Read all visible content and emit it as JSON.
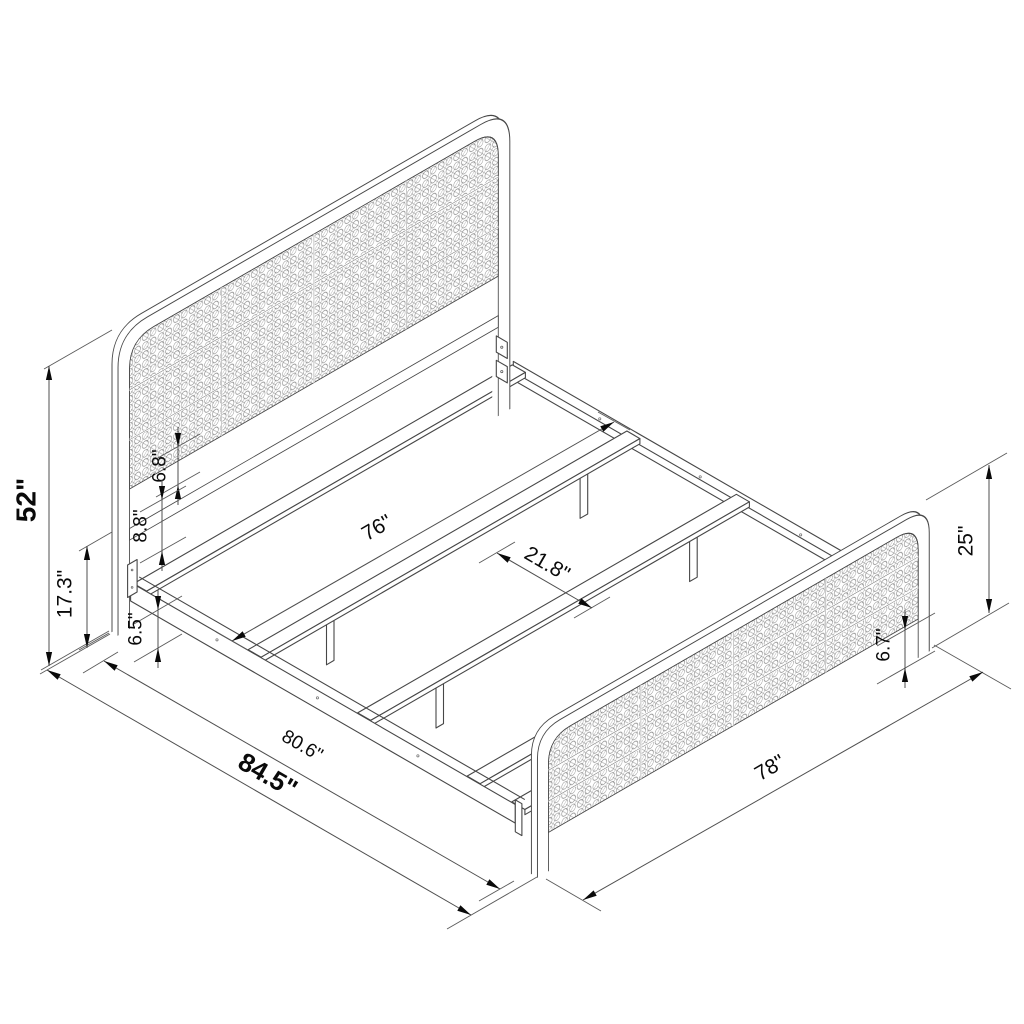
{
  "diagram": {
    "type": "isometric_dimension_drawing",
    "subject": "metal platform bed frame with cane headboard and footboard",
    "background_color": "#ffffff",
    "line_color": "#474747",
    "dimension_text_color": "#0a0a0a",
    "dimensions": [
      {
        "id": "headboard-height",
        "label": "52\"",
        "emphasis": "bold"
      },
      {
        "id": "floor-to-crossbar",
        "label": "17.3\"",
        "emphasis": "regular"
      },
      {
        "id": "crossbar-to-panel-gap",
        "label": "6.8\"",
        "emphasis": "regular"
      },
      {
        "id": "rail-to-panel-gap",
        "label": "8.8\"",
        "emphasis": "regular"
      },
      {
        "id": "floor-to-rail-clearance",
        "label": "6.5\"",
        "emphasis": "regular"
      },
      {
        "id": "inner-slat-length",
        "label": "76\"",
        "emphasis": "regular"
      },
      {
        "id": "slat-spacing",
        "label": "21.8\"",
        "emphasis": "regular"
      },
      {
        "id": "frame-length",
        "label": "80.6\"",
        "emphasis": "regular"
      },
      {
        "id": "overall-length",
        "label": "84.5\"",
        "emphasis": "bold"
      },
      {
        "id": "overall-width",
        "label": "78\"",
        "emphasis": "regular"
      },
      {
        "id": "footboard-height",
        "label": "25\"",
        "emphasis": "regular"
      },
      {
        "id": "footboard-panel-clearance",
        "label": "6.7\"",
        "emphasis": "regular"
      }
    ]
  }
}
